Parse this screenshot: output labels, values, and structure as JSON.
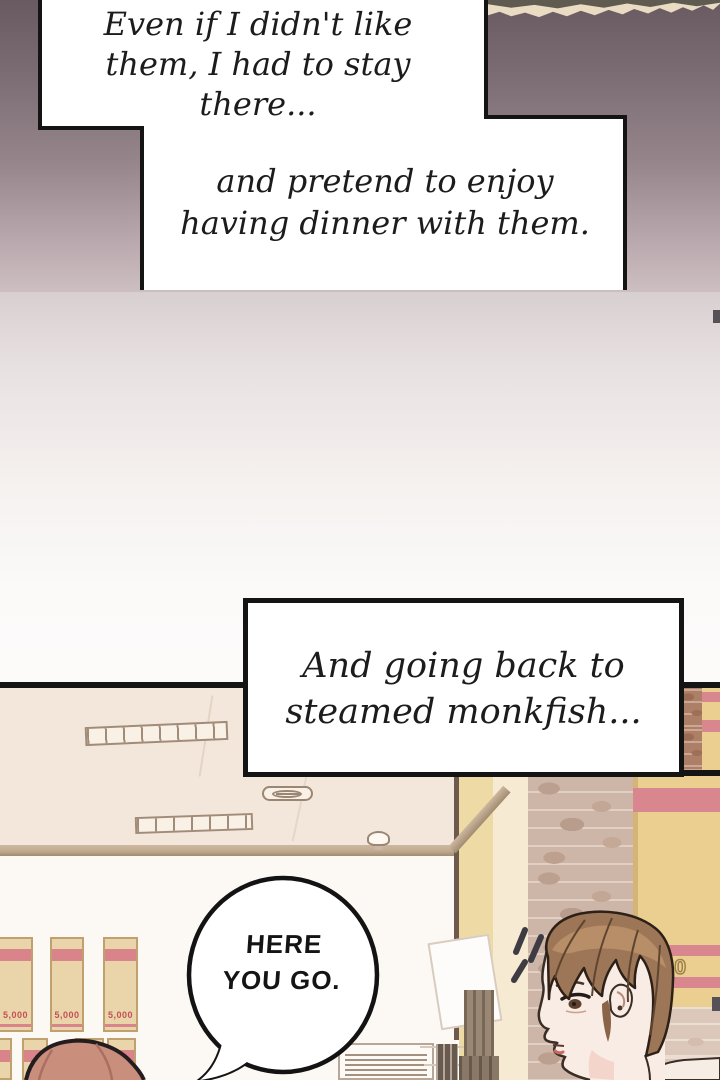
{
  "comic": {
    "narration_box_1": {
      "line1": "Even if I didn't like",
      "line2": "them, I had to stay there..."
    },
    "narration_box_2": {
      "line1": "and pretend to enjoy",
      "line2": "having dinner with them."
    },
    "narration_box_3": {
      "line1": "And going back to",
      "line2": "steamed monkfish..."
    },
    "speech_bubble": {
      "line1": "HERE",
      "line2": "YOU GO."
    },
    "wall_sign_text": "000",
    "shelf_boxes": [
      {
        "price": "5,000"
      },
      {
        "price": "5,000"
      },
      {
        "price": "5,000"
      }
    ],
    "colors": {
      "panel_border": "#141414",
      "top_gradient_start": "#695a62",
      "top_gradient_end": "#ccbec1",
      "ceiling": "#f3e7db",
      "wall_white": "#fcf8f4",
      "brick": "#cdb5a7",
      "sign_tan": "#ebcf90",
      "sign_stripe_pink": "#d9878f",
      "shelf_box_tan": "#ead4aa",
      "shelf_stripe_pink": "#d9838a",
      "hair_brown": "#9c7657",
      "hair_auburn": "#c98f7c",
      "skin": "#f9ece4"
    }
  }
}
